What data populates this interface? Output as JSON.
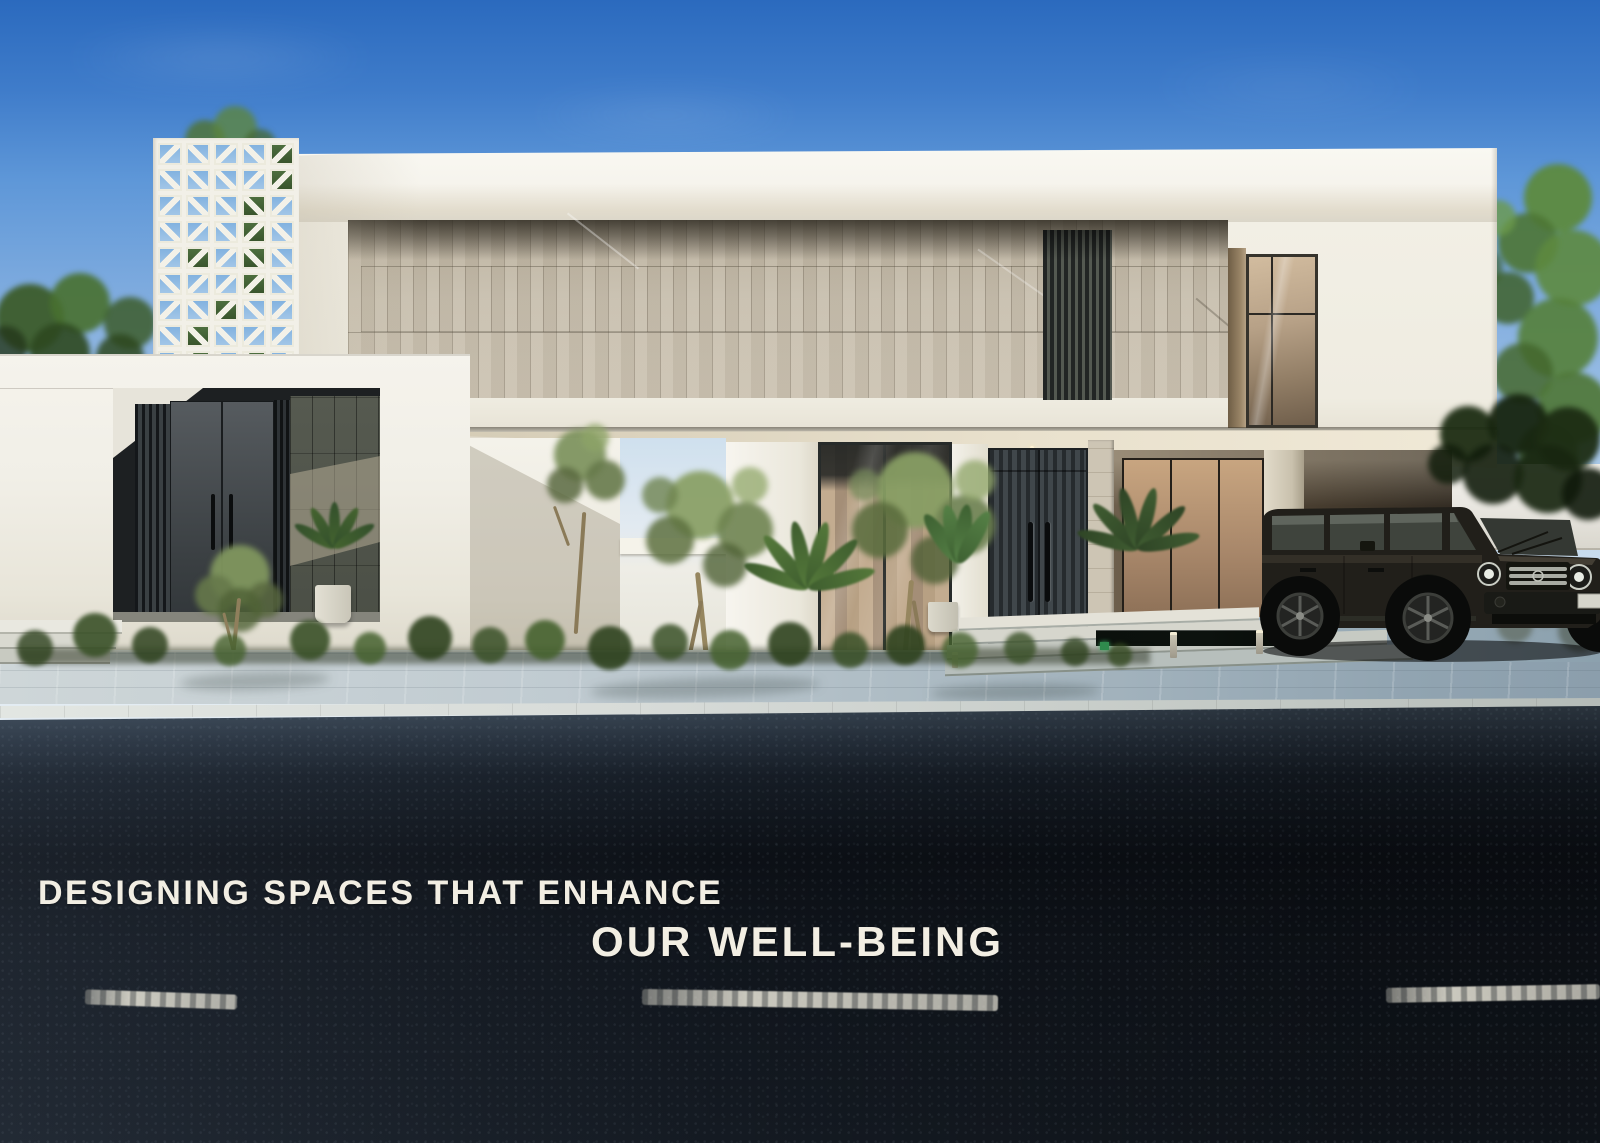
{
  "caption": {
    "line1": "DESIGNING SPACES THAT ENHANCE",
    "line2": "OUR WELL-BEING"
  },
  "palette": {
    "sky_top": "#2b6abe",
    "sky_mid": "#5e97d8",
    "sky_low": "#a9c9e8",
    "sky_horizon": "#d8e5f0",
    "wall_white": "#f6f4ed",
    "stone_beige": "#c8bfae",
    "louver_dark": "#222524",
    "door_dark": "#32373a",
    "ceiling_warm": "#e9e1cd",
    "foliage_green": "#5d7a41",
    "trunk": "#93815f",
    "paver_grey": "#c0cbd1",
    "curb": "#d7dbd8",
    "road_dark": "#0c1016",
    "road_sheen": "#3a4754",
    "lane_mark": "#e6e3d6",
    "pool": "#0c120e",
    "bound_wall": "#eae8e2",
    "car_black": "#211f1a",
    "caption": "#f2eee3"
  }
}
